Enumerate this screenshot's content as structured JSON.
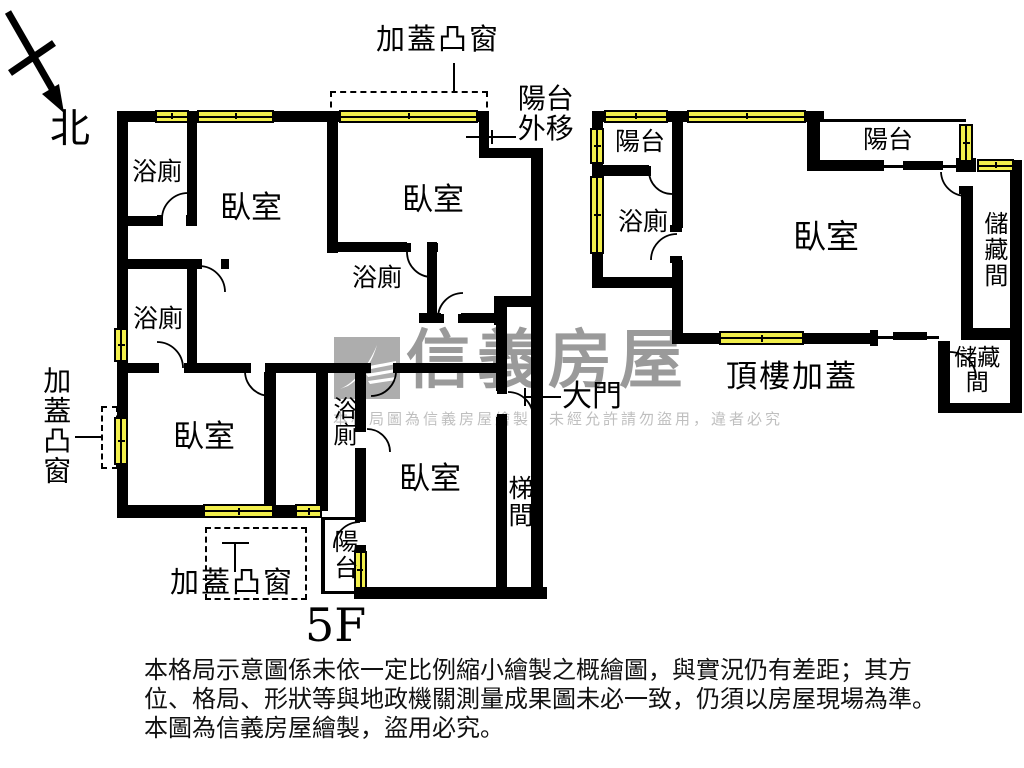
{
  "plan": {
    "floor_label": "5F",
    "compass_label": "北",
    "unit5f": {
      "bay_top": "加蓋凸窗",
      "balcony_shift": "陽台外移",
      "bath_top": "浴廁",
      "bed_top_left": "臥室",
      "bed_top_right": "臥室",
      "bath_mid": "浴廁",
      "bath_left": "浴廁",
      "bed_bottom_left": "臥室",
      "bath_small": "浴廁",
      "bed_bottom_right": "臥室",
      "balcony_bottom": "陽台",
      "stairwell": "梯間",
      "main_door": "大門",
      "bay_left": "加蓋凸窗",
      "bay_bottom": "加蓋凸窗"
    },
    "rooftop": {
      "title": "頂樓加蓋",
      "balcony_left": "陽台",
      "bath": "浴廁",
      "bedroom": "臥室",
      "balcony_right": "陽台",
      "storage_right": "儲藏間",
      "storage_bottom": "儲藏間"
    }
  },
  "watermark": {
    "brand": "信義房屋",
    "tagline": "本格局圖為信義房屋繪製，未經允許請勿盜用，違者必究"
  },
  "disclaimer": {
    "line1": "本格局示意圖係未依一定比例縮小繪製之概繪圖，與實況仍有差距；其方",
    "line2": "位、格局、形狀等與地政機關測量成果圖未必一致，仍須以房屋現場為準。",
    "line3": "本圖為信義房屋繪製，盜用必究。"
  },
  "colors": {
    "wall": "#000000",
    "window_fill": "#f1ee4b",
    "watermark_gray": "#9a9a9a",
    "tagline_gray": "#bfbfbf"
  }
}
